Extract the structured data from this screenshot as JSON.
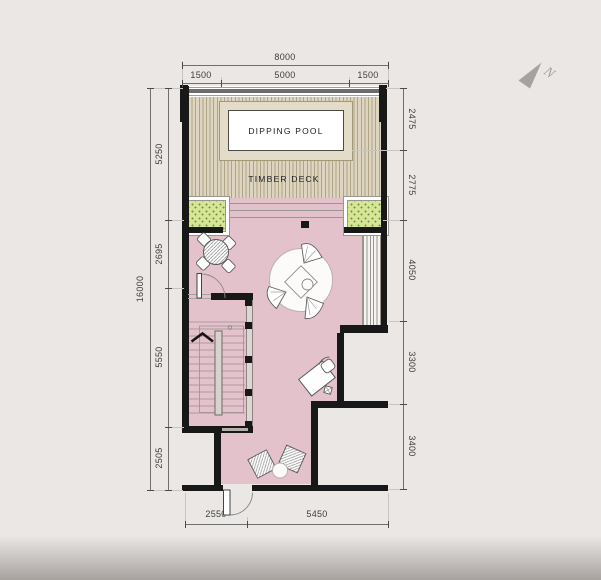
{
  "labels": {
    "pool": "DIPPING POOL",
    "deck": "TIMBER DECK",
    "north": "N"
  },
  "dims": {
    "top_total": "8000",
    "top_segments": [
      "1500",
      "5000",
      "1500"
    ],
    "left_total": "16000",
    "left_segments": [
      "5250",
      "2695",
      "5550",
      "2505"
    ],
    "right_segments": [
      "2475",
      "2775",
      "4050",
      "3300",
      "3400"
    ],
    "bottom_segments": [
      "2550",
      "5450"
    ]
  },
  "colors": {
    "floor": "#e4c2cc",
    "deck": "#ddd5c0",
    "planter": "#d5e795",
    "wall": "#181818",
    "background": "#e9e6e3"
  }
}
